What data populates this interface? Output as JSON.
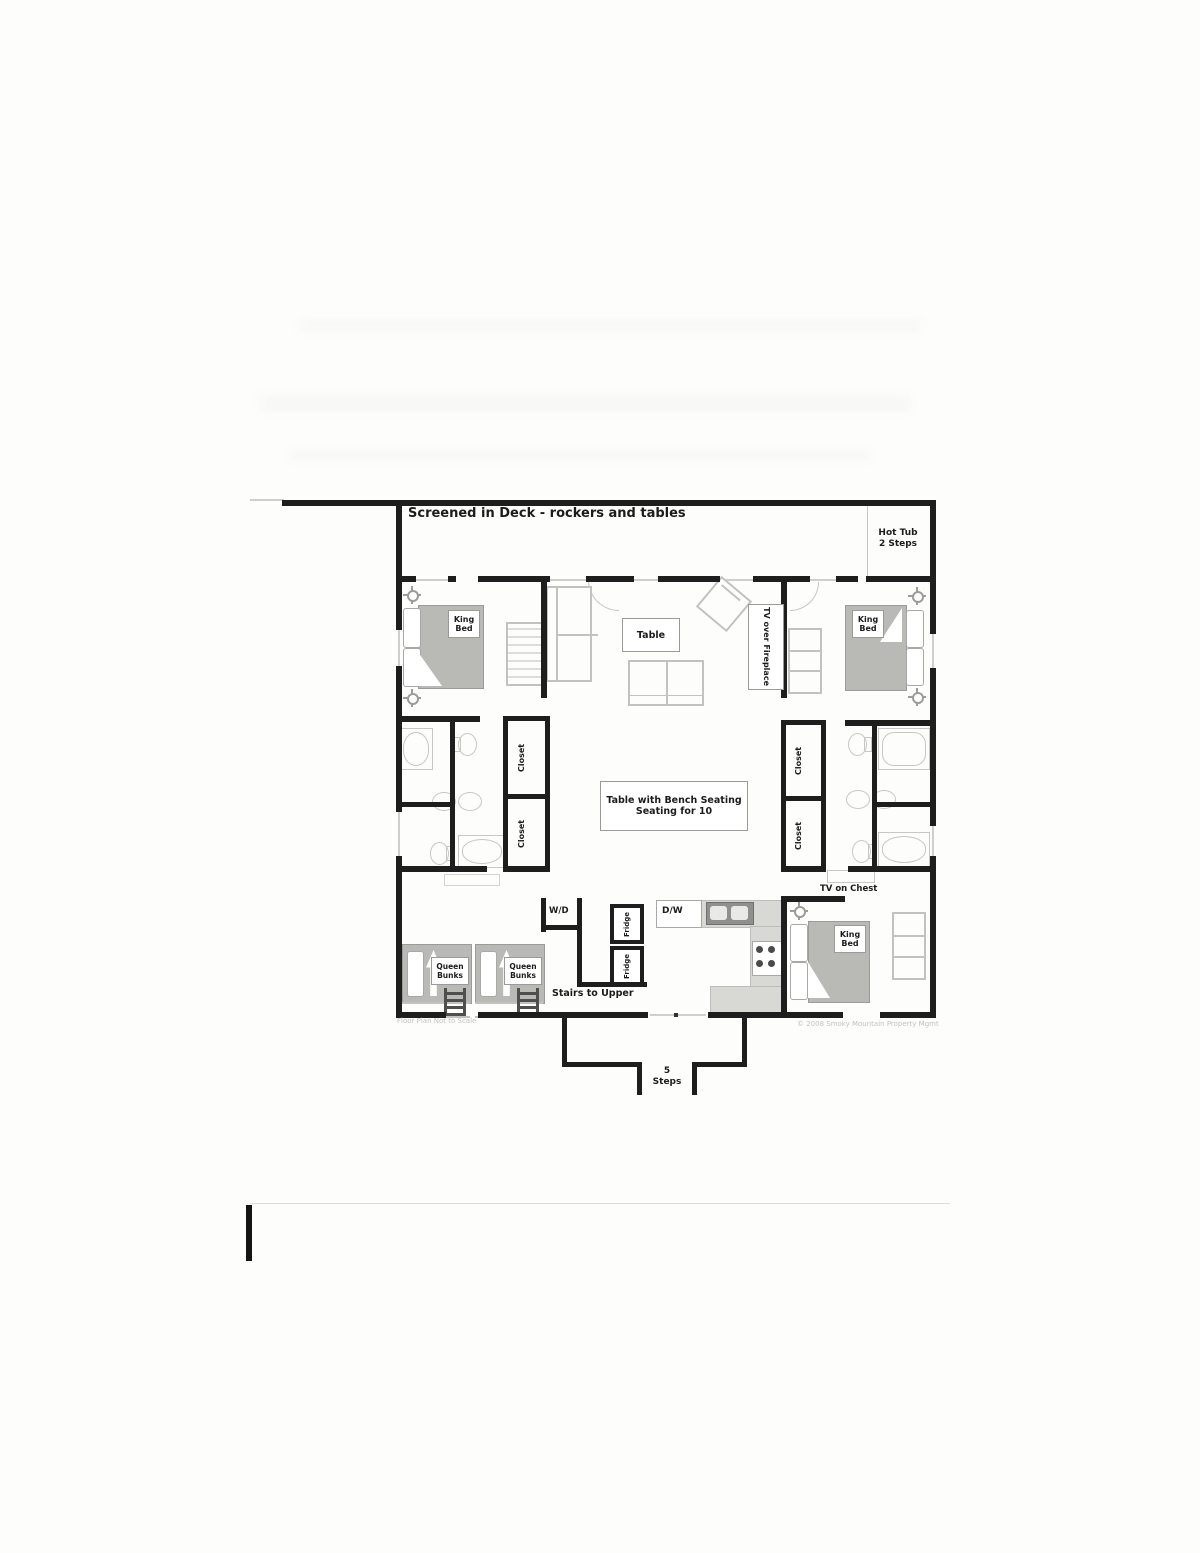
{
  "floorplan": {
    "deck": {
      "title": "Screened in Deck - rockers and tables"
    },
    "hot_tub": {
      "line1": "Hot Tub",
      "line2": "2 Steps"
    },
    "king_bed": {
      "line1": "King",
      "line2": "Bed"
    },
    "queen_bunks": {
      "line1": "Queen",
      "line2": "Bunks"
    },
    "living": {
      "table": "Table",
      "tv_fireplace": "TV over Fireplace"
    },
    "dining": {
      "line1": "Table with Bench Seating",
      "line2": "Seating for 10"
    },
    "closet": "Closet",
    "laundry": "W/D",
    "kitchen": {
      "dishwasher": "D/W",
      "fridge": "Fridge"
    },
    "stairs": "Stairs to Upper",
    "entry": {
      "line1": "5",
      "line2": "Steps"
    },
    "hall": {
      "tv_chest": "TV on Chest"
    },
    "footnotes": {
      "scale": "Floor Plan Not to Scale",
      "copyright": "© 2008 Smoky Mountain Property Mgmt"
    },
    "colors": {
      "wall": "#1e1e1e",
      "bed_gray": "#b9b9b6",
      "counter_gray": "#d8d8d4",
      "outline_gray": "#c2c2bf"
    }
  }
}
